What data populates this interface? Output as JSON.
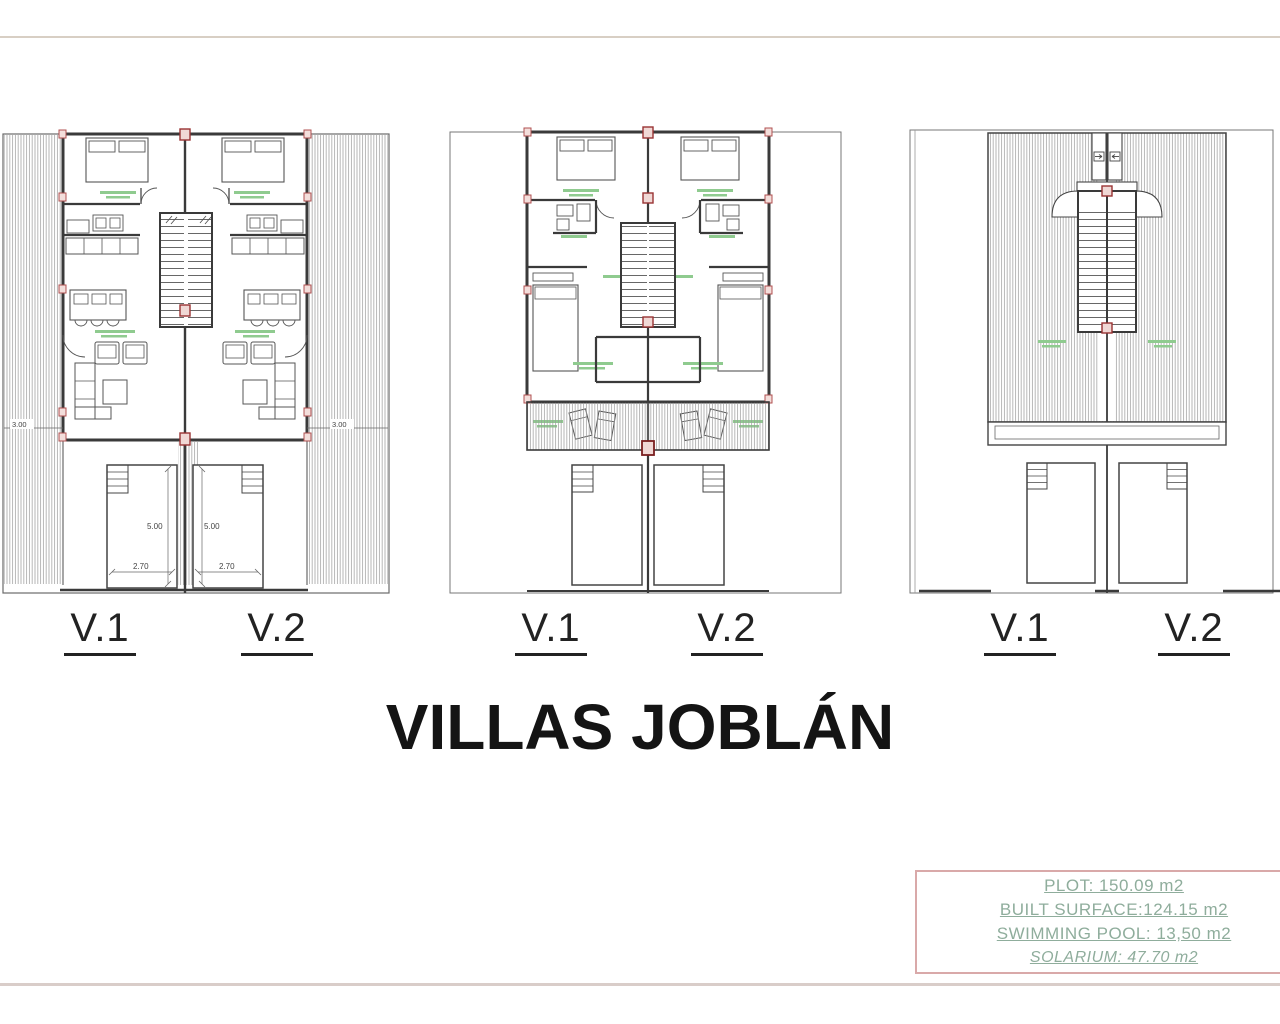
{
  "page": {
    "title": "VILLAS JOBLÁN"
  },
  "plans": {
    "ground": {
      "villa1": "V.1",
      "villa2": "V.2",
      "dims": {
        "side_left": "3.00",
        "side_right": "3.00",
        "pool_length_v1": "5.00",
        "pool_length_v2": "5.00",
        "pool_width_v1": "2.70",
        "pool_width_v2": "2.70"
      }
    },
    "first": {
      "villa1": "V.1",
      "villa2": "V.2"
    },
    "roof": {
      "villa1": "V.1",
      "villa2": "V.2"
    }
  },
  "info_box": {
    "plot": "PLOT: 150.09 m2",
    "built_surface": "BUILT SURFACE:124.15 m2",
    "swimming_pool": "SWIMMING POOL: 13,50 m2",
    "solarium": "SOLARIUM: 47.70 m2"
  },
  "colors": {
    "accent_green": "#8fcb8f",
    "info_green": "#8fad9c",
    "border_pink": "#d9a9a9",
    "pillar_red": "#b05050",
    "wall_dark": "#3a3a3a"
  }
}
